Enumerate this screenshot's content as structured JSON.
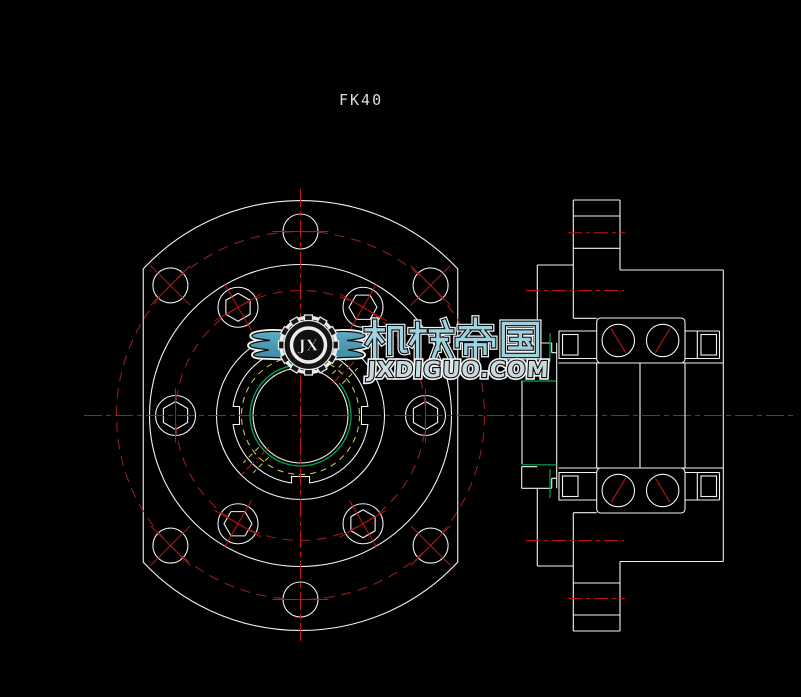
{
  "drawing": {
    "label": "FK40",
    "type": "2D CAD engineering drawing, FK40 ballscrew support unit",
    "views": {
      "front_view": {
        "name": "front-view",
        "mounting_holes": 6,
        "hex_socket_screw_holes": 6,
        "bolt_circle_style": "red dash-dot",
        "center_feature": "threaded bore with green thread arc and yellow dashed circle"
      },
      "section_view": {
        "name": "side-section-view",
        "bearings": 2,
        "balls_per_bearing": 2,
        "ball_contact_lines": "red diagonals"
      }
    }
  },
  "watermark": {
    "brand_text": "机械帝国",
    "url_text": "JXDIGUO.COM",
    "monogram": "JX"
  },
  "colors": {
    "bg": "#000000",
    "line": "#f2f2f2",
    "red": "#c01414",
    "red_dash": "#a02121",
    "green": "#00a550",
    "yellow": "#c6c63c",
    "teal": "#57a5bc",
    "url_fill": "#c9d9e0"
  }
}
